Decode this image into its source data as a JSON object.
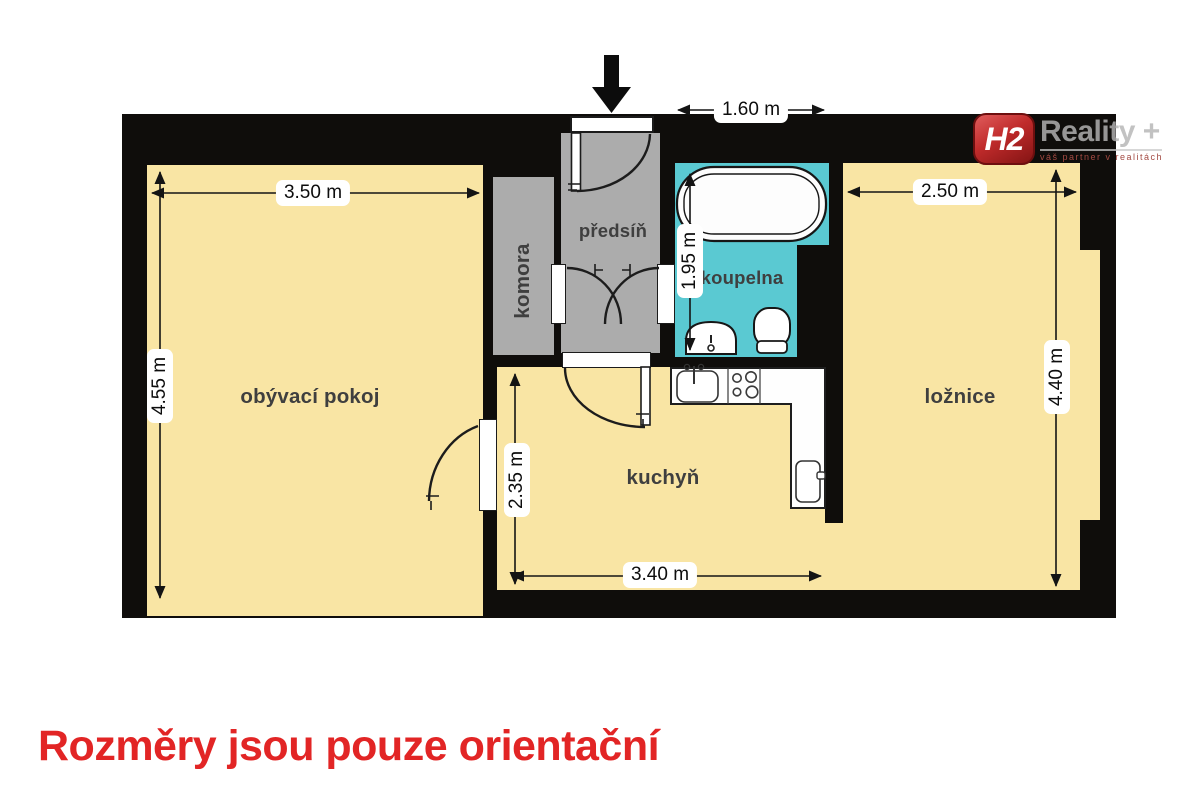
{
  "logo": {
    "monogram": "H2",
    "brand": "Reality +",
    "tagline": "váš partner v realitách"
  },
  "rooms": {
    "living_room": {
      "label": "obývací pokoj",
      "width_label": "3.50 m",
      "height_label": "4.55 m"
    },
    "pantry": {
      "label": "komora"
    },
    "hallway": {
      "label": "předsíň",
      "entry_width_label": "1.60 m"
    },
    "bathroom": {
      "label": "koupelna",
      "height_label": "1.95 m"
    },
    "kitchen": {
      "label": "kuchyň",
      "width_label": "3.40 m",
      "height_label": "2.35 m"
    },
    "bedroom": {
      "label": "ložnice",
      "width_label": "2.50 m",
      "height_label": "4.40 m"
    }
  },
  "footer": {
    "disclaimer": "Rozměry jsou pouze orientační"
  },
  "icons": {
    "entrance": "down-arrow"
  },
  "colors": {
    "room_fill": "#f9e5a4",
    "service_fill": "#acacac",
    "bathroom_fill": "#5ac9d2",
    "wall": "#0f0d0b",
    "accent_red": "#e22525",
    "logo_gray": "#b5b5b5"
  }
}
